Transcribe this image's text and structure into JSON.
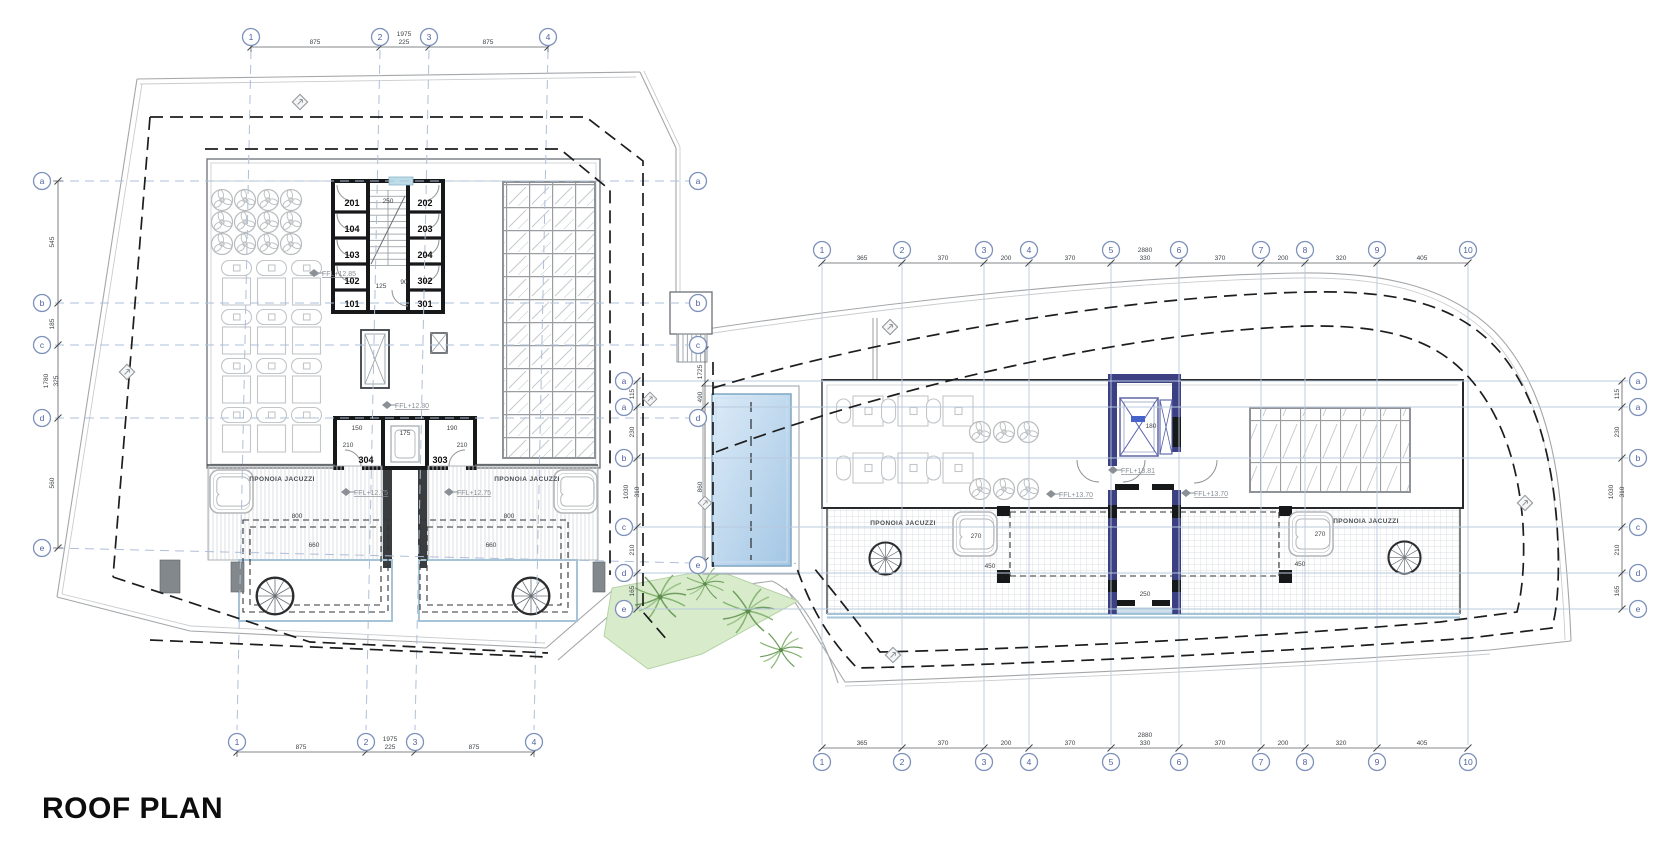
{
  "title": "ROOF PLAN",
  "left_building": {
    "cols": [
      "1",
      "2",
      "3",
      "4"
    ],
    "rows": [
      "a",
      "b",
      "c",
      "d",
      "e"
    ],
    "dims_h": [
      "875",
      "1975",
      "225",
      "875"
    ],
    "dims_v": [
      "545",
      "185",
      "1780",
      "325",
      "560"
    ],
    "rooms_left": [
      "201",
      "104",
      "103",
      "102",
      "101"
    ],
    "rooms_right": [
      "202",
      "203",
      "204",
      "302",
      "301"
    ],
    "rooms_lower": [
      "304",
      "303"
    ],
    "stair_dims": [
      "250",
      "125",
      "90"
    ],
    "shaft_dims": [
      "150",
      "175",
      "190",
      "210",
      "210"
    ],
    "terrace_dims": [
      "800",
      "660",
      "800",
      "660"
    ],
    "jacuzzi_note": "ΠΡΟΝΟΙΑ JACUZZI",
    "ffl": [
      "FFL+12.85",
      "FFL+12.80",
      "FFL+12.75",
      "FFL+12.75"
    ]
  },
  "middle": {
    "dims_v": [
      "1725",
      "490",
      "860"
    ]
  },
  "right_building": {
    "cols": [
      "1",
      "2",
      "3",
      "4",
      "5",
      "6",
      "7",
      "8",
      "9",
      "10"
    ],
    "rows": [
      "a",
      "a",
      "b",
      "c",
      "d",
      "e"
    ],
    "dims_h": [
      "365",
      "370",
      "200",
      "370",
      "2880",
      "330",
      "370",
      "200",
      "320",
      "405"
    ],
    "dims_v": [
      "115",
      "230",
      "1030",
      "310",
      "210",
      "165"
    ],
    "ffl": [
      "FFL+13.81",
      "FFL+13.70",
      "FFL+13.70"
    ],
    "jacuzzi_note": "ΠΡΟΝΟΙΑ JACUZZI",
    "terrace_dims": [
      "270",
      "450",
      "270",
      "450"
    ],
    "core_dims": [
      "180",
      "250"
    ]
  },
  "colors": {
    "grid_line": "#b9c9de",
    "wall": "#17181a",
    "navy_core": "#3c4082",
    "pool": "#aecbe6",
    "landscape_green": "#d8ebcb",
    "dashed_setback": "#1d1d1d",
    "terrace_edge": "#a5c4d8"
  }
}
